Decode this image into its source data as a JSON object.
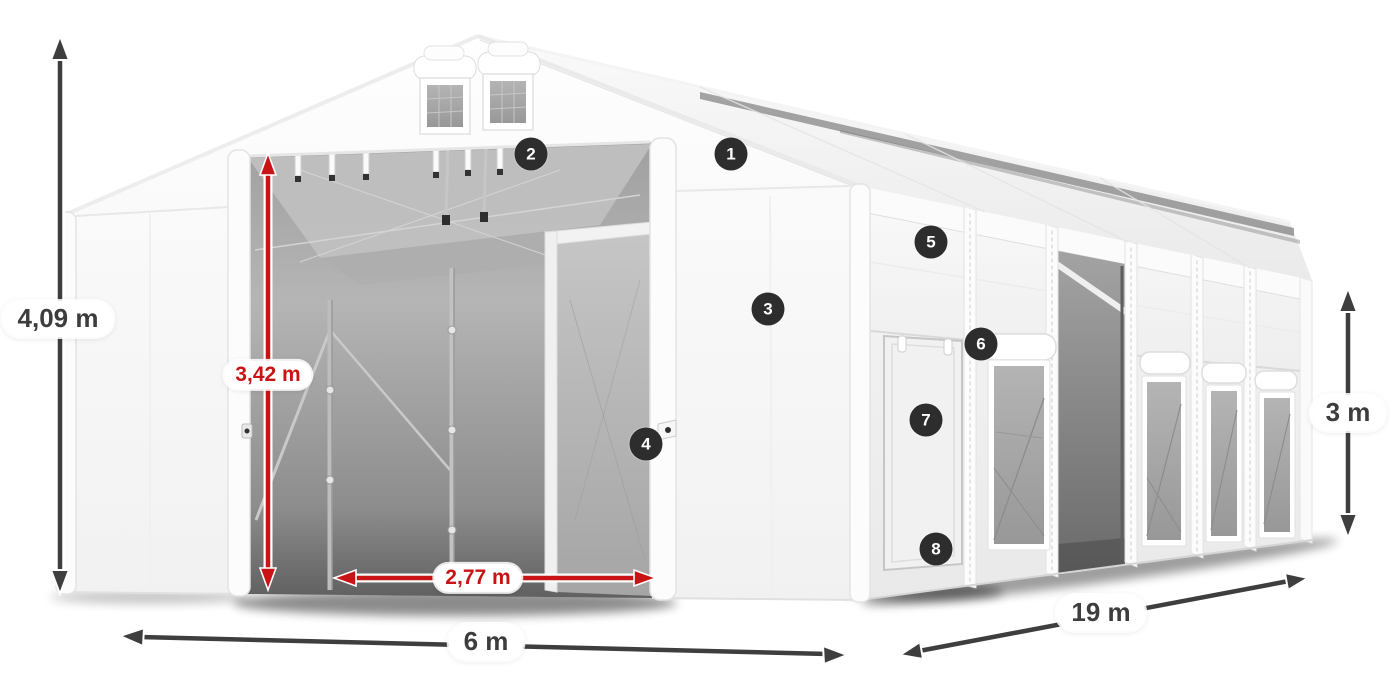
{
  "illustration": {
    "subject": "white-storage-tent-with-dimensions",
    "background_color": "#ffffff"
  },
  "dimensions": {
    "total_height": {
      "label": "4,09 m",
      "color": "#3d3d3d"
    },
    "entrance_height": {
      "label": "3,42 m",
      "color": "#c81414"
    },
    "entrance_width": {
      "label": "2,77 m",
      "color": "#c81414"
    },
    "width": {
      "label": "6 m",
      "color": "#3d3d3d"
    },
    "length": {
      "label": "19 m",
      "color": "#3d3d3d"
    },
    "side_height": {
      "label": "3 m",
      "color": "#3d3d3d"
    }
  },
  "callouts": [
    {
      "number": "1"
    },
    {
      "number": "2"
    },
    {
      "number": "3"
    },
    {
      "number": "4"
    },
    {
      "number": "5"
    },
    {
      "number": "6"
    },
    {
      "number": "7"
    },
    {
      "number": "8"
    }
  ],
  "colors": {
    "dimension_dark": "#3d3d3d",
    "dimension_red": "#c81414",
    "callout_background": "#2d2d2d",
    "callout_text": "#ffffff",
    "tent_fabric": "#f5f5f5",
    "mesh_gray": "#a9a9a9"
  }
}
